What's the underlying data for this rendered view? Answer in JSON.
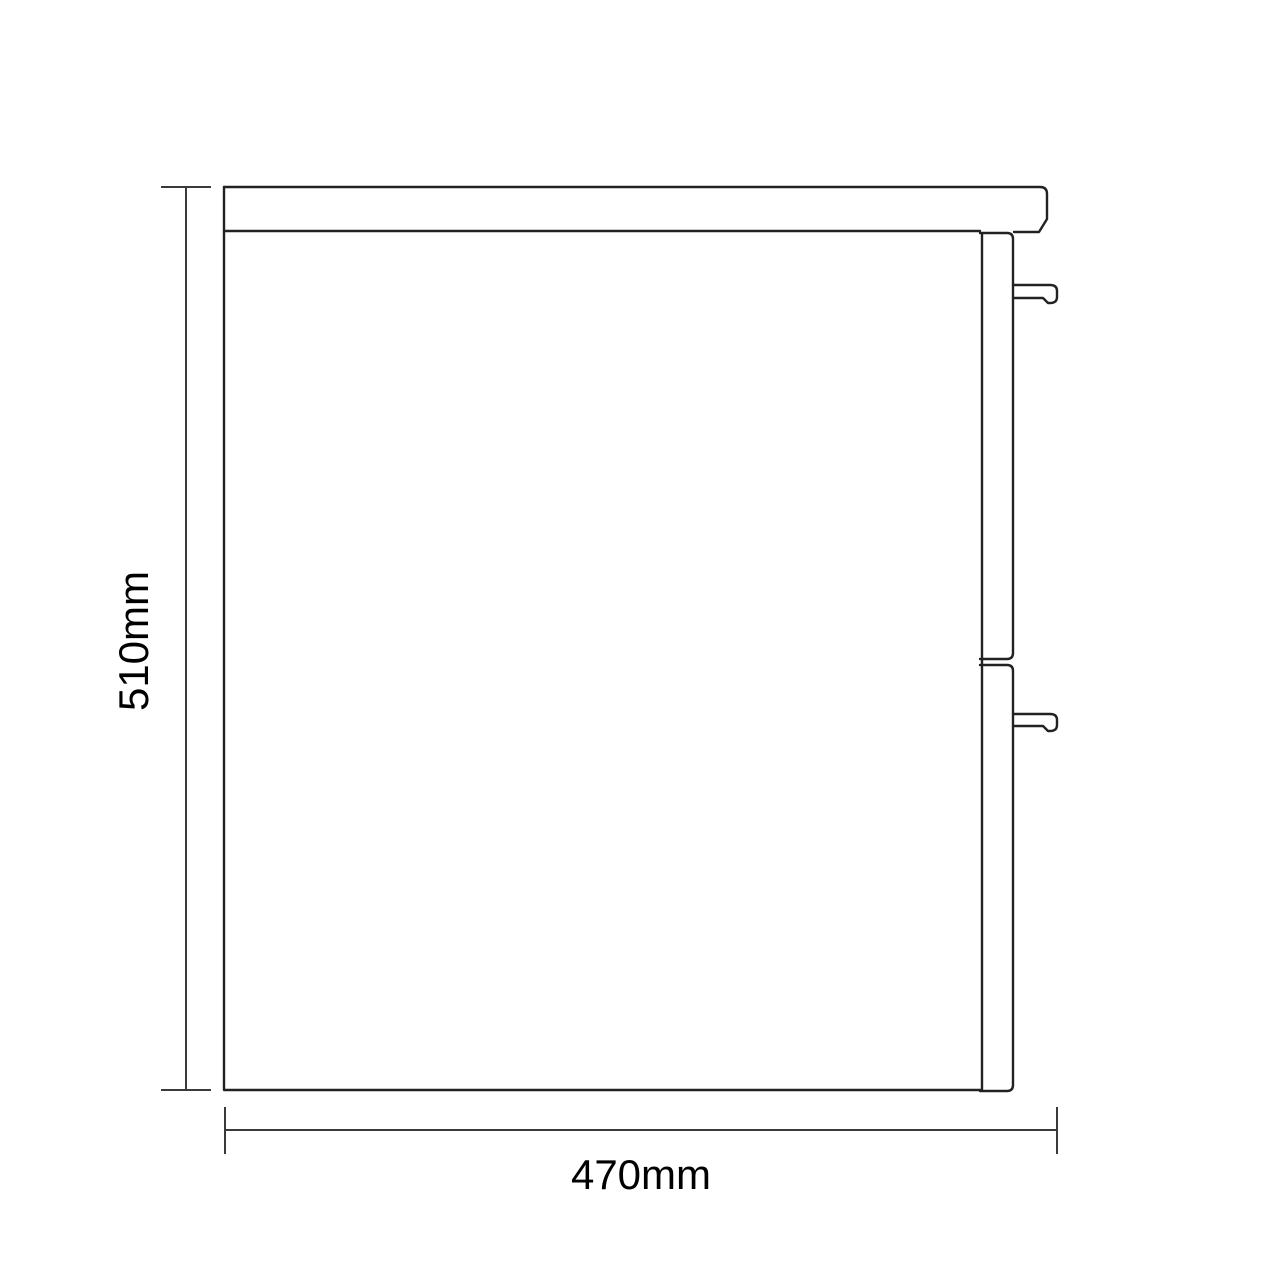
{
  "dimensions": {
    "height_label": "510mm",
    "width_label": "470mm"
  },
  "style": {
    "background_color": "#ffffff",
    "drawing_line_color": "#222222",
    "dimension_line_color": "#3a3a3a",
    "label_color": "#000000"
  }
}
